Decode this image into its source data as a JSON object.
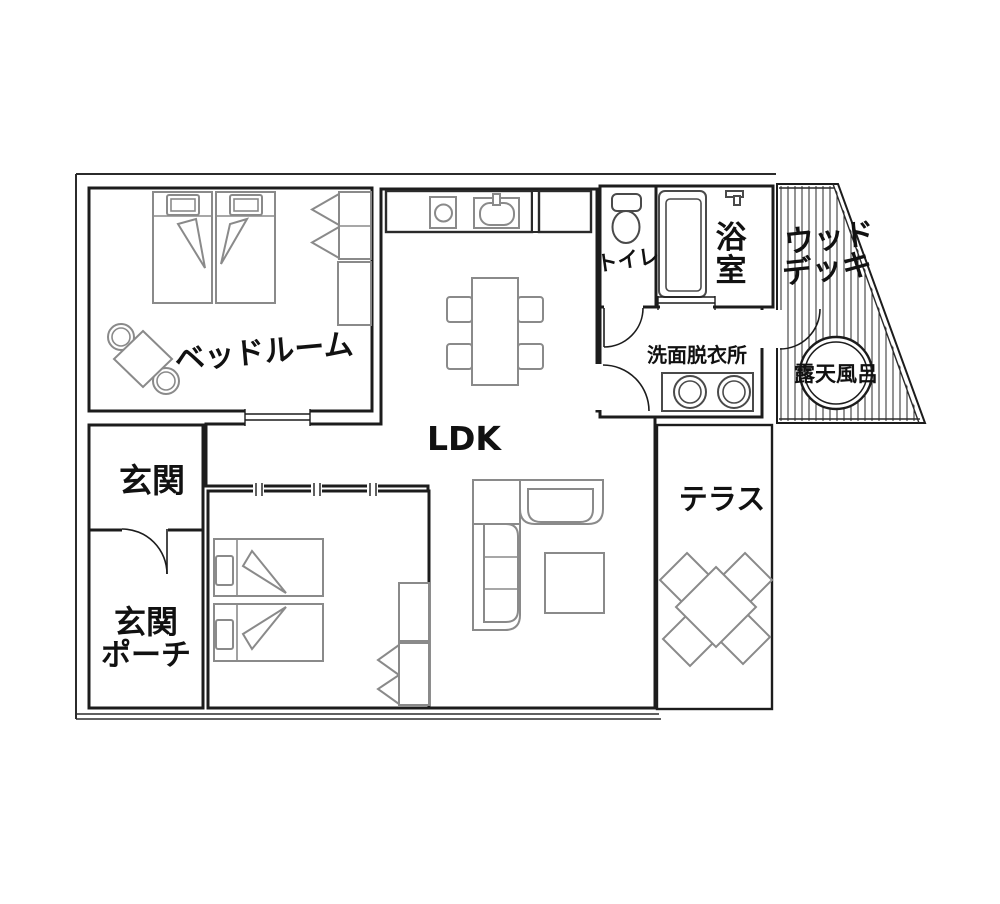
{
  "floorplan": {
    "rooms": {
      "bedroom": {
        "label": "ベッドルーム"
      },
      "ldk": {
        "label": "LDK"
      },
      "entrance": {
        "label": "玄関"
      },
      "entrance_porch": {
        "line1": "玄関",
        "line2": "ポーチ"
      },
      "toilet": {
        "label": "トイレ"
      },
      "bathroom": {
        "char1": "浴",
        "char2": "室"
      },
      "washroom": {
        "label": "洗面脱衣所"
      },
      "wood_deck": {
        "line1": "ウッド",
        "line2": "デッキ"
      },
      "open_air_bath": {
        "label": "露天風呂"
      },
      "terrace": {
        "label": "テラス"
      }
    },
    "colors": {
      "wall": "#1c1c1c",
      "outer_boundary": "#2b2b2b",
      "furniture": "#8a8a8a",
      "fixture": "#4a4a4a",
      "text": "#111111",
      "background": "#ffffff"
    }
  }
}
